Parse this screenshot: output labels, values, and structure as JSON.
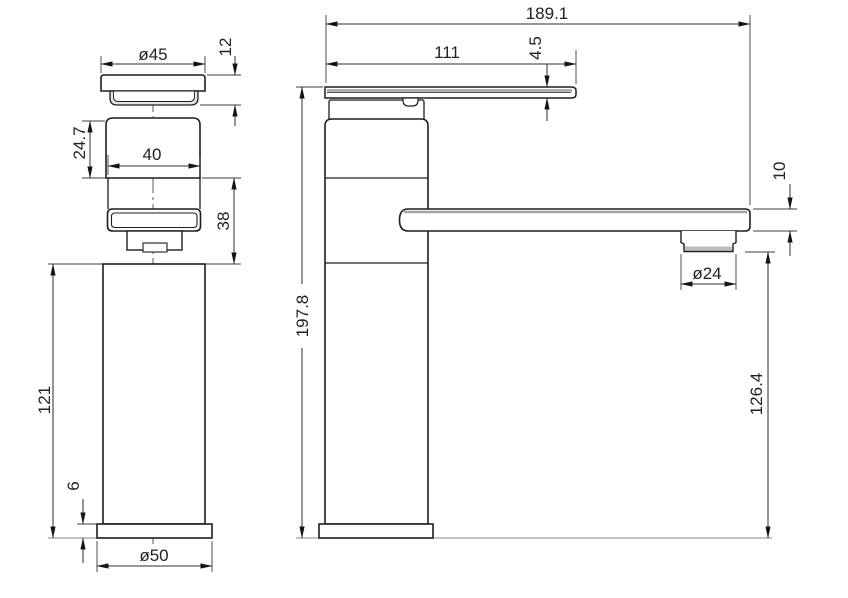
{
  "drawing": {
    "views": {
      "front": {
        "dims": {
          "cap_diameter": "ø45",
          "cap_height": "12",
          "neck_height": "24.7",
          "cartridge_width": "40",
          "spout_block_height": "38",
          "column_height": "121",
          "base_plate_height": "6",
          "base_diameter": "ø50"
        }
      },
      "side": {
        "dims": {
          "overall_reach": "189.1",
          "handle_reach": "111",
          "handle_plate_thickness": "4.5",
          "overall_height": "197.8",
          "spout_thickness": "10",
          "aerator_diameter": "ø24",
          "spout_underside_height": "126.4"
        }
      }
    }
  }
}
